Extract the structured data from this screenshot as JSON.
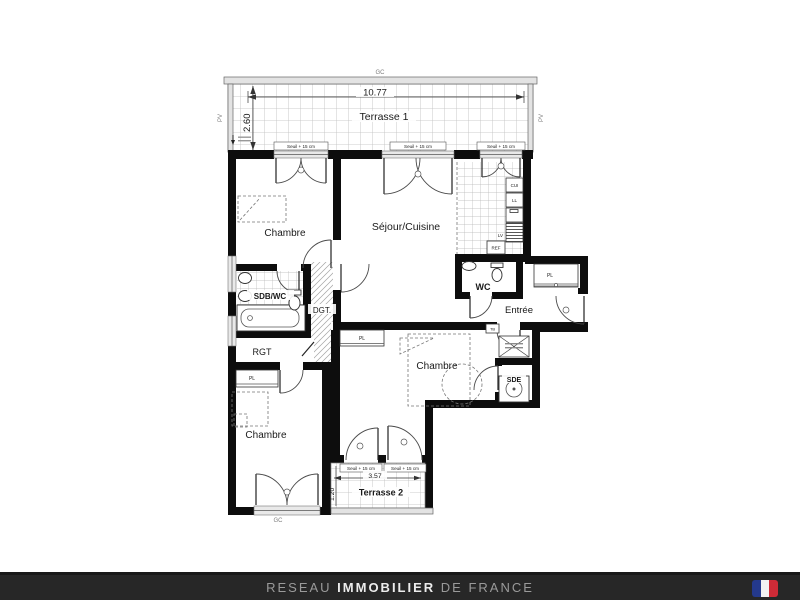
{
  "plan": {
    "rooms": {
      "terrasse1": "Terrasse 1",
      "chambre": "Chambre",
      "sejour": "Séjour/Cuisine",
      "sdb": "SDB/WC",
      "dgt": "DGT.",
      "rgt": "RGT",
      "wc": "WC",
      "entree": "Entrée",
      "sde": "SDE",
      "terrasse2": "Terrasse 2"
    },
    "dims": {
      "terrasse1_width": "10.77",
      "terrasse1_depth": "2.60",
      "terrasse2_width": "3.57",
      "terrasse2_depth": "1.20"
    },
    "labels": {
      "seuil": "Seuil + 15 cm",
      "gc": "GC",
      "pv": "PV",
      "pl": "PL",
      "tb": "TB",
      "cui": "CUI",
      "ll": "LL",
      "lv": "LV",
      "ref": "REF"
    }
  },
  "footer": {
    "brand_prefix": "RESEAU ",
    "brand_main": "IMMOBILIER",
    "brand_suffix": " DE FRANCE"
  },
  "colors": {
    "wall": "#0d0d0d",
    "footer_bg": "#272727",
    "flag_blue": "#24398C",
    "flag_white": "#F2F2F2",
    "flag_red": "#CE2B37"
  }
}
